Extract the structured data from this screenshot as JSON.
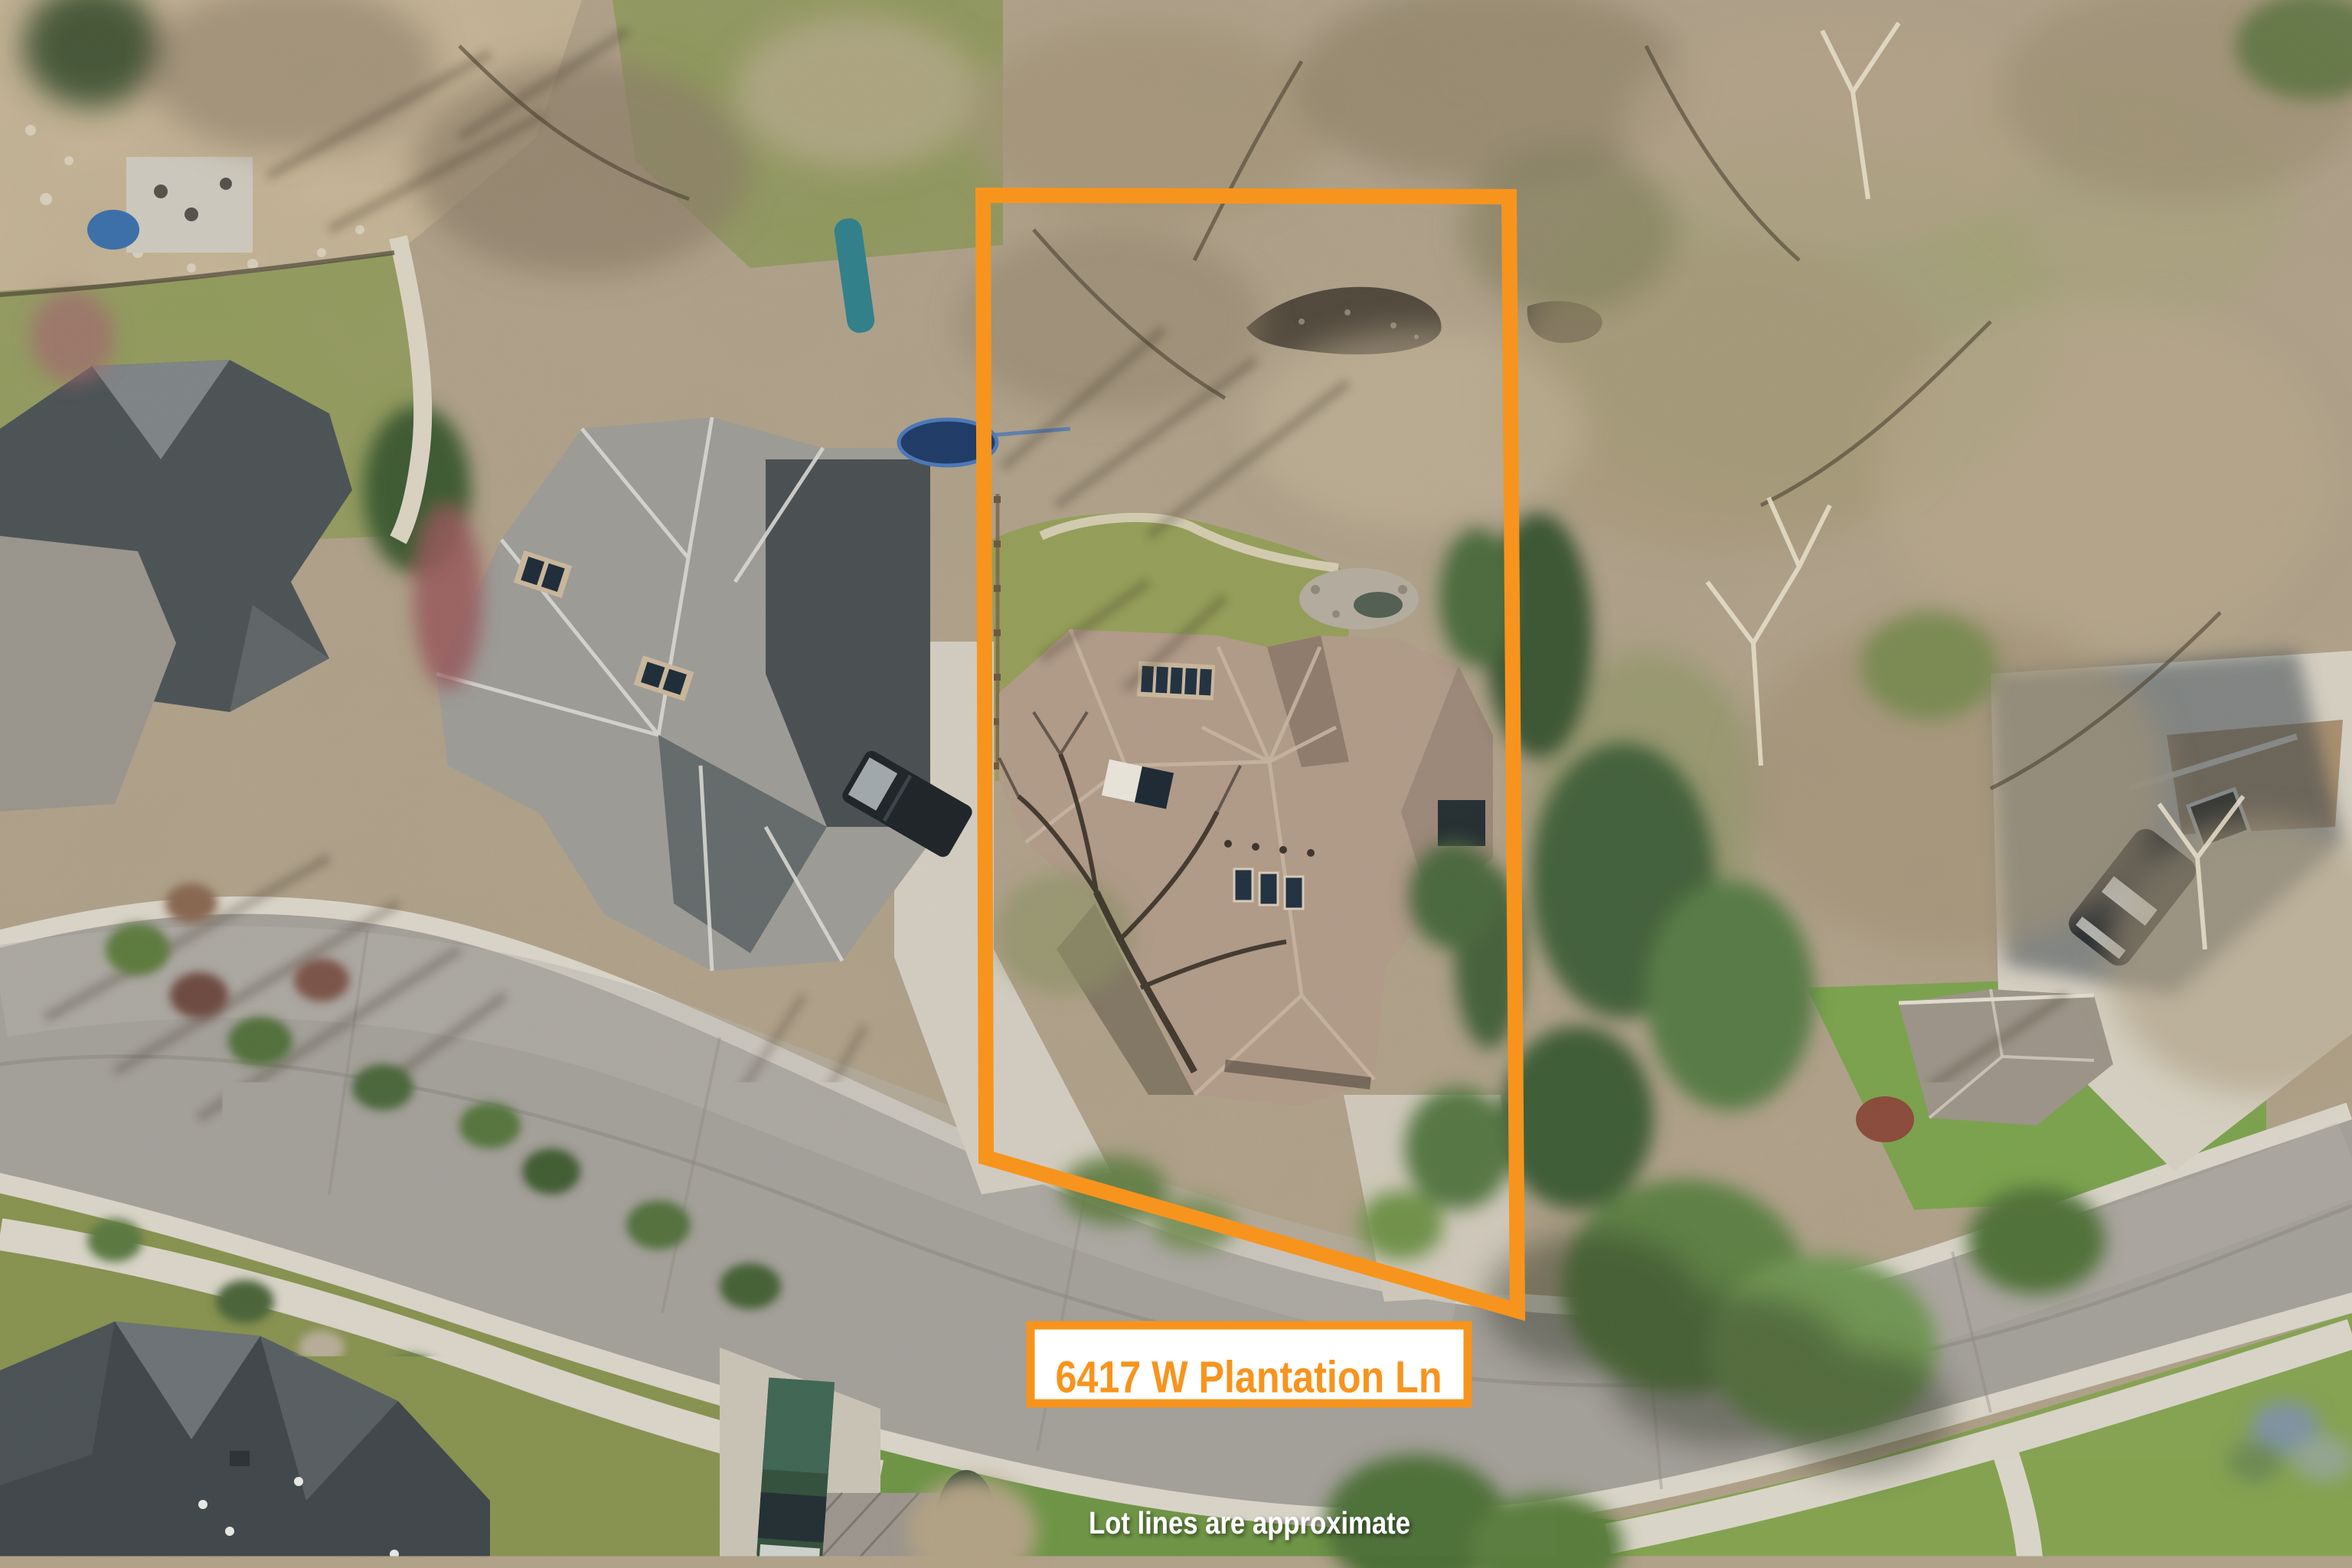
{
  "scene": {
    "type": "aerial-property-photo",
    "address_label": "6417 W Plantation Ln",
    "caption": "Lot lines are approximate",
    "watermark": {
      "line1": "INTERMOUNTAIN",
      "line2": "MLS"
    },
    "colors": {
      "boundary": "#F7941D",
      "label_background": "#FFFFFF",
      "label_text": "#F7941D",
      "caption_text": "#FFFFFF",
      "watermark_text": "#FFFFFF",
      "road_asphalt": "#A39F99",
      "concrete": "#D9D4C8",
      "scrub_ground": "#B0A189",
      "lawn_green": "#8C9758",
      "subject_roof": "#B09A88",
      "neighbor_roof": "#9C9B96",
      "dark_roof": "#4B5254",
      "conifer_green": "#42603A",
      "creek_water": "#51483C"
    }
  }
}
